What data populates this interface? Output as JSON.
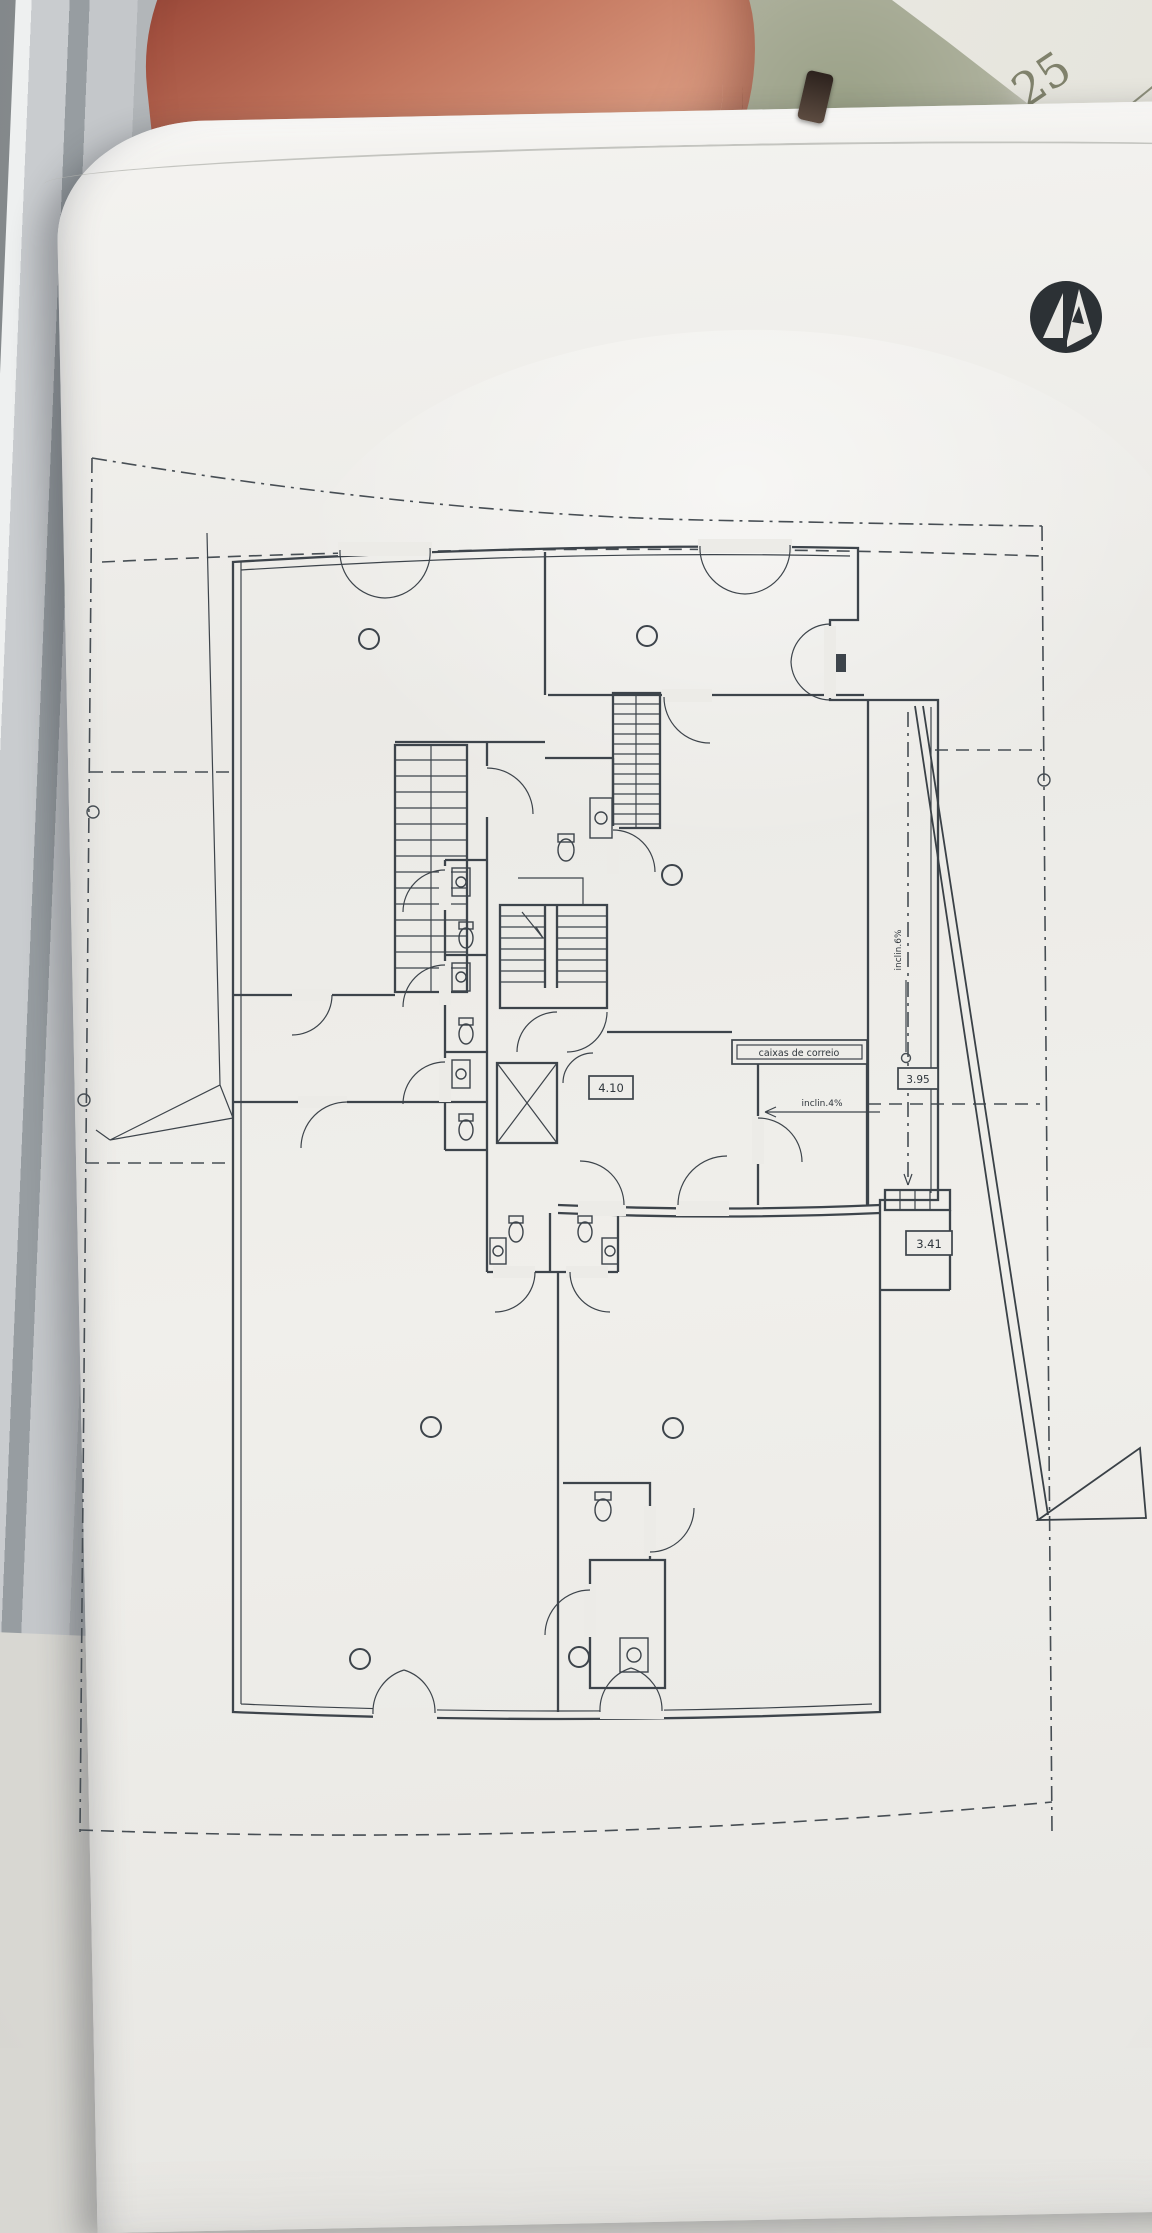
{
  "photo": {
    "corner_note": "25"
  },
  "plan": {
    "ink": "#3d444b",
    "labels": {
      "mailboxes": "caixas de correio",
      "hall_width": "4.10",
      "ramp_width_top": "3.95",
      "ramp_width_bottom": "3.41",
      "entry_ramp_slope": "inclin.4%",
      "side_ramp_slope": "inclin.6%"
    }
  },
  "logo": {
    "color": "#2c3135"
  }
}
